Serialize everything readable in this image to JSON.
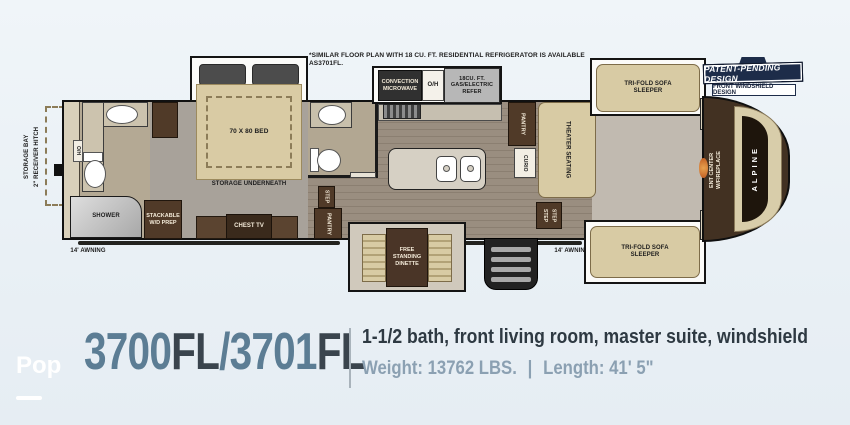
{
  "note": "*SIMILAR FLOOR PLAN WITH 18 CU. FT. RESIDENTIAL REFRIGERATOR IS AVAILABLE AS3701FL.",
  "banner": {
    "patent": "PATENT-PENDING DESIGN",
    "windshield": "FRONT WINDSHIELD DESIGN"
  },
  "fp": {
    "storage_bay": "STORAGE BAY",
    "receiver_hitch": "2\" RECEIVER HITCH",
    "awning_left": "14' AWNING",
    "awning_right": "14' AWNING",
    "shower": "SHOWER",
    "wd_prep": "STACKABLE W/D PREP",
    "oh_bath": "O/H",
    "bed": "70 X 80 BED",
    "storage_underneath": "STORAGE UNDERNEATH",
    "chest_tv": "CHEST TV",
    "step_bedroom": "STEP",
    "pantry_bedroom": "PANTRY",
    "microwave": "CONVECTION MICROWAVE",
    "oh_kitchen": "O/H",
    "refer": "18CU. FT. GAS/ELECTRIC REFER",
    "dinette": "FREE STANDING DINETTE",
    "pantry_living": "PANTRY",
    "curio": "CURIO",
    "theater": "THEATER SEATING",
    "step_a": "STEP",
    "step_b": "STEP",
    "sofa_top": "TRI-FOLD SOFA SLEEPER",
    "sofa_bottom": "TRI-FOLD SOFA SLEEPER",
    "ent_center": "ENT CENTER W/FIREPLACE",
    "brand": "ALPINE"
  },
  "info": {
    "model_a": "3700",
    "model_a_suffix": "FL",
    "model_slash": "/",
    "model_b": "3701",
    "model_b_suffix": "FL",
    "description": "1-1/2 bath, front living room, master suite, windshield",
    "weight": "Weight: 13762 LBS.",
    "separator": "|",
    "length": "Length: 41' 5\""
  },
  "watermark": {
    "text": "Pop"
  },
  "colors": {
    "model_number": "#5c7d94",
    "model_suffix": "#3a444d",
    "banner_navy": "#1d2c49",
    "cabinet_brown": "#503a28",
    "upholstery_beige": "#d8cba4",
    "background": "#ecf2f7"
  }
}
